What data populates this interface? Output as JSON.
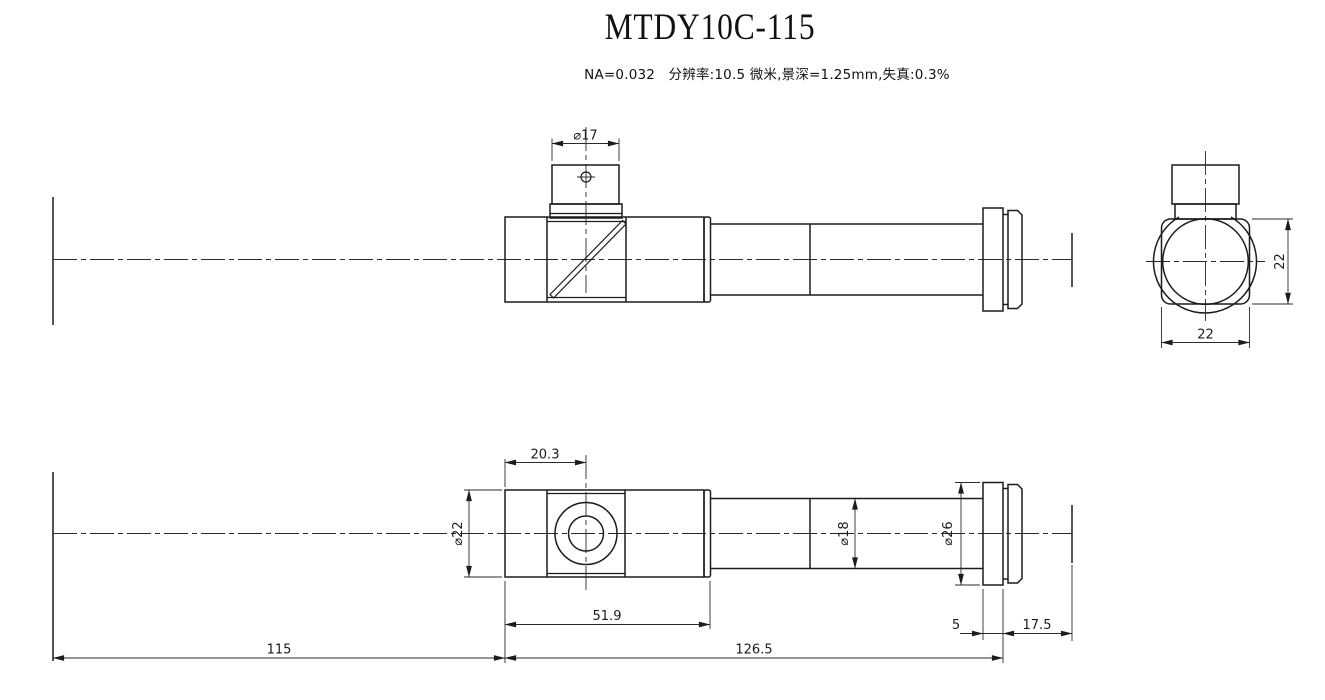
{
  "title": "MTDY10C-115",
  "specs": "NA=0.032   分辨率:10.5 微米,景深=1.25mm,失真:0.3%",
  "dimensions": {
    "port_diameter": "⌀17",
    "port_offset": "20.3",
    "body_diameter": "⌀22",
    "body_length": "51.9",
    "tube_diameter": "⌀18",
    "flange_diameter": "⌀26",
    "object_distance": "115",
    "mount_length": "126.5",
    "flange_thickness": "5",
    "back_distance": "17.5",
    "end_width": "22",
    "end_height": "22"
  }
}
